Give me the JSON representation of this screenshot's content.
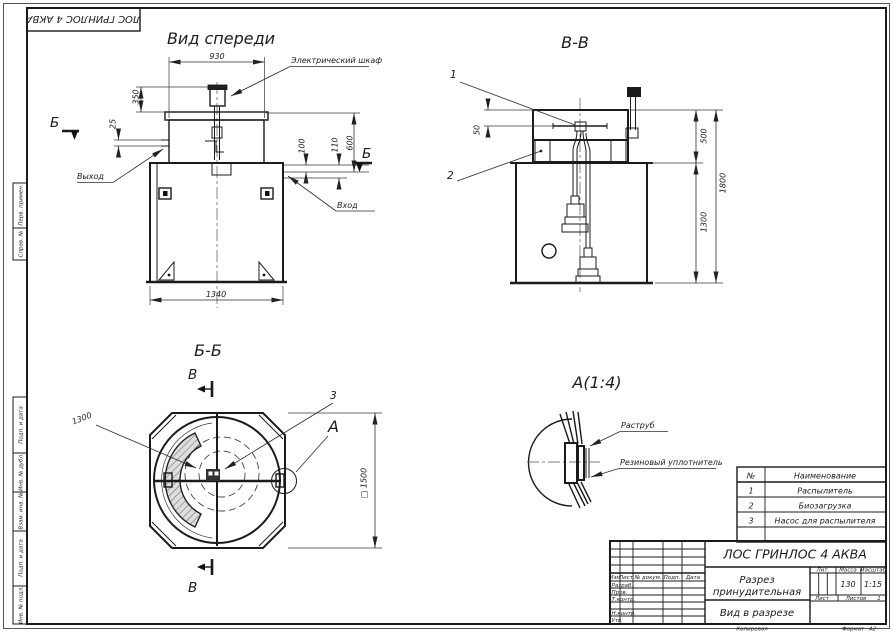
{
  "corner_stamp": {
    "designation": "ЛОС ГРИНЛОС 4 АКВА"
  },
  "side_stamps": {
    "perv_primen": "Перв. примен.",
    "sprav_no": "Справ. №",
    "podp_data_1": "Подп. и дата",
    "inv_dubl": "Инв. № дубл.",
    "vzam_inv": "Взам. инв. №",
    "podp_data_2": "Подп. и дата",
    "inv_podl": "Инв. № подл."
  },
  "front_view": {
    "title": "Вид спереди",
    "dim_930": "930",
    "dim_350": "350",
    "dim_25": "25",
    "dim_100": "100",
    "dim_110": "110",
    "dim_600": "600",
    "dim_1340": "1340",
    "label_cabinet": "Электрический шкаф",
    "label_outlet": "Выход",
    "label_inlet": "Вход",
    "marker": "Б"
  },
  "section_vv": {
    "title": "В-В",
    "callout_1": "1",
    "callout_2": "2",
    "dim_50": "50",
    "dim_500": "500",
    "dim_1800": "1800",
    "dim_1300": "1300"
  },
  "section_bb": {
    "title": "Б-Б",
    "marker": "В",
    "callout_3": "3",
    "detail_label": "А",
    "dim_1300": "1300",
    "dim_1500": "□ 1500"
  },
  "detail_a": {
    "title": "А(1:4)",
    "label_socket": "Раструб",
    "label_seal": "Резиновый уплотнитель"
  },
  "parts_table": {
    "col_no": "№",
    "col_name": "Наименование",
    "rows": [
      {
        "no": "1",
        "name": "Распылитель"
      },
      {
        "no": "2",
        "name": "Биозагрузка"
      },
      {
        "no": "3",
        "name": "Насос для распылителя"
      }
    ]
  },
  "title_block": {
    "designation": "ЛОС ГРИНЛОС 4 АКВА",
    "name_line1": "Разрез",
    "name_line2": "принудительная",
    "view_name": "Вид в разрезе",
    "col_izm": "Изм",
    "col_list": "Лист",
    "col_doc": "№ докум.",
    "col_podp": "Подп.",
    "col_data": "Дата",
    "row_razrab": "Разраб.",
    "row_prov": "Пров.",
    "row_tkontr": "Т.контр.",
    "row_nkontr": "Н.контр.",
    "row_utv": "Утв.",
    "lit_label": "Лит.",
    "massa_label": "Масса",
    "masshtab_label": "Масштаб",
    "massa_value": "130",
    "masshtab_value": "1:15",
    "list_label": "Лист",
    "listov_label": "Листов",
    "listov_value": "1",
    "copied": "Копировал",
    "format_label": "Формат",
    "format_value": "А2"
  }
}
